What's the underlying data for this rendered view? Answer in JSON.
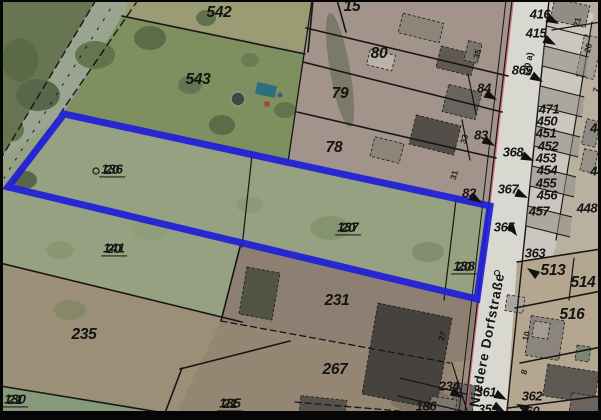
{
  "map": {
    "kind": "cadastral parcel map over aerial photo",
    "highlight_color": "#1f1fd9",
    "street": {
      "name": "Niedere Dorfstraße",
      "width_note": "(20 a)"
    }
  },
  "parcel_labels": {
    "542": "542",
    "15": "15",
    "543": "543",
    "80": "80",
    "79": "79",
    "78": "78",
    "235": "235",
    "231": "231",
    "267": "267",
    "513": "513",
    "514": "514",
    "516": "516"
  },
  "fraction_labels": {
    "136": {
      "num": "136",
      "den": "20"
    },
    "137": {
      "num": "137",
      "den": "20"
    },
    "138": {
      "num": "138",
      "den": "20"
    },
    "141": {
      "num": "141",
      "den": "20"
    },
    "130": {
      "num": "130",
      "den": "21"
    },
    "185": {
      "num": "185",
      "den": "21"
    }
  },
  "point_labels": {
    "416": "416",
    "415": "415",
    "869": "869",
    "84": "84",
    "83": "83",
    "82": "82",
    "368": "368",
    "367": "367",
    "365": "365",
    "363": "363",
    "471": "471",
    "450": "450",
    "451": "451",
    "452": "452",
    "453": "453",
    "454": "454",
    "455": "455",
    "456": "456",
    "457": "457",
    "448": "448",
    "44a": "44",
    "44b": "44",
    "234": "234",
    "186": "186",
    "361": "361",
    "359": "359",
    "362": "362",
    "360": "360"
  },
  "house_numbers": {
    "35": "35",
    "33": "33",
    "31": "31",
    "27": "27",
    "21": "21",
    "20": "20",
    "7": "7",
    "10": "10",
    "8": "8"
  }
}
